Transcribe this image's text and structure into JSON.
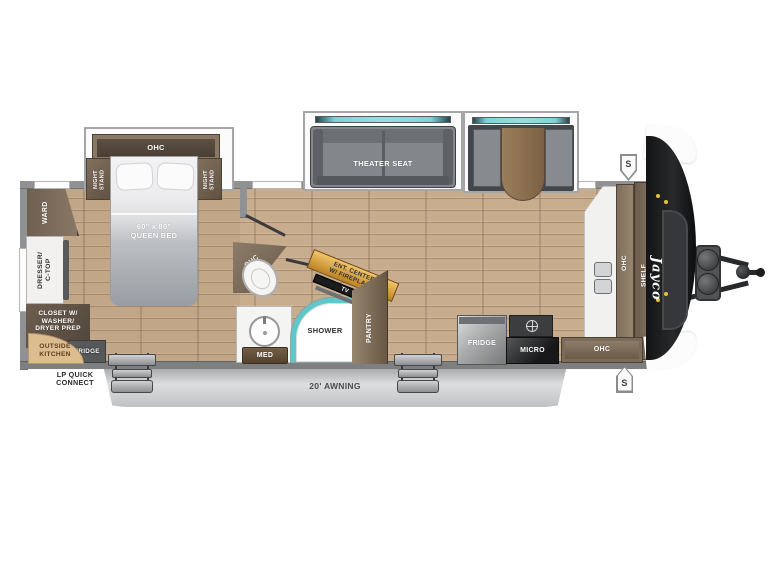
{
  "exterior": {
    "awning_label": "20' AWNING",
    "lp_quick_connect": "LP QUICK\nCONNECT",
    "speaker_label": "S",
    "brand_logo": "Jayco"
  },
  "bedroom": {
    "ohc": "OHC",
    "night_stand_left": "NIGHT\nSTAND",
    "night_stand_right": "NIGHT\nSTAND",
    "queen_bed": "60\" x 80\"\nQUEEN BED",
    "ward": "WARD",
    "dresser": "DRESSER/\nC-TOP",
    "closet": "CLOSET W/\nWASHER/\nDRYER PREP",
    "outside_kitchen": "OUTSIDE\nKITCHEN",
    "outside_fridge": "FRIDGE"
  },
  "living": {
    "theater_seat": "THEATER SEAT",
    "ent_center": "ENT. CENTER\nW/ FIREPLACE",
    "tv": "TV"
  },
  "bath": {
    "ohc": "OHC",
    "shower": "SHOWER",
    "med": "MED"
  },
  "kitchen": {
    "pantry": "PANTRY",
    "fridge": "FRIDGE",
    "micro": "MICRO",
    "ohc_bottom": "OHC",
    "ohc_side": "OHC",
    "shelf": "SHELF"
  },
  "colors": {
    "accent_teal": "#5fc6ca",
    "ent_center_gold": "#d99b33",
    "floor_tan": "#c8ac8e",
    "cabinet_brown": "#7a6a58",
    "wall_gray": "#8f9193"
  }
}
